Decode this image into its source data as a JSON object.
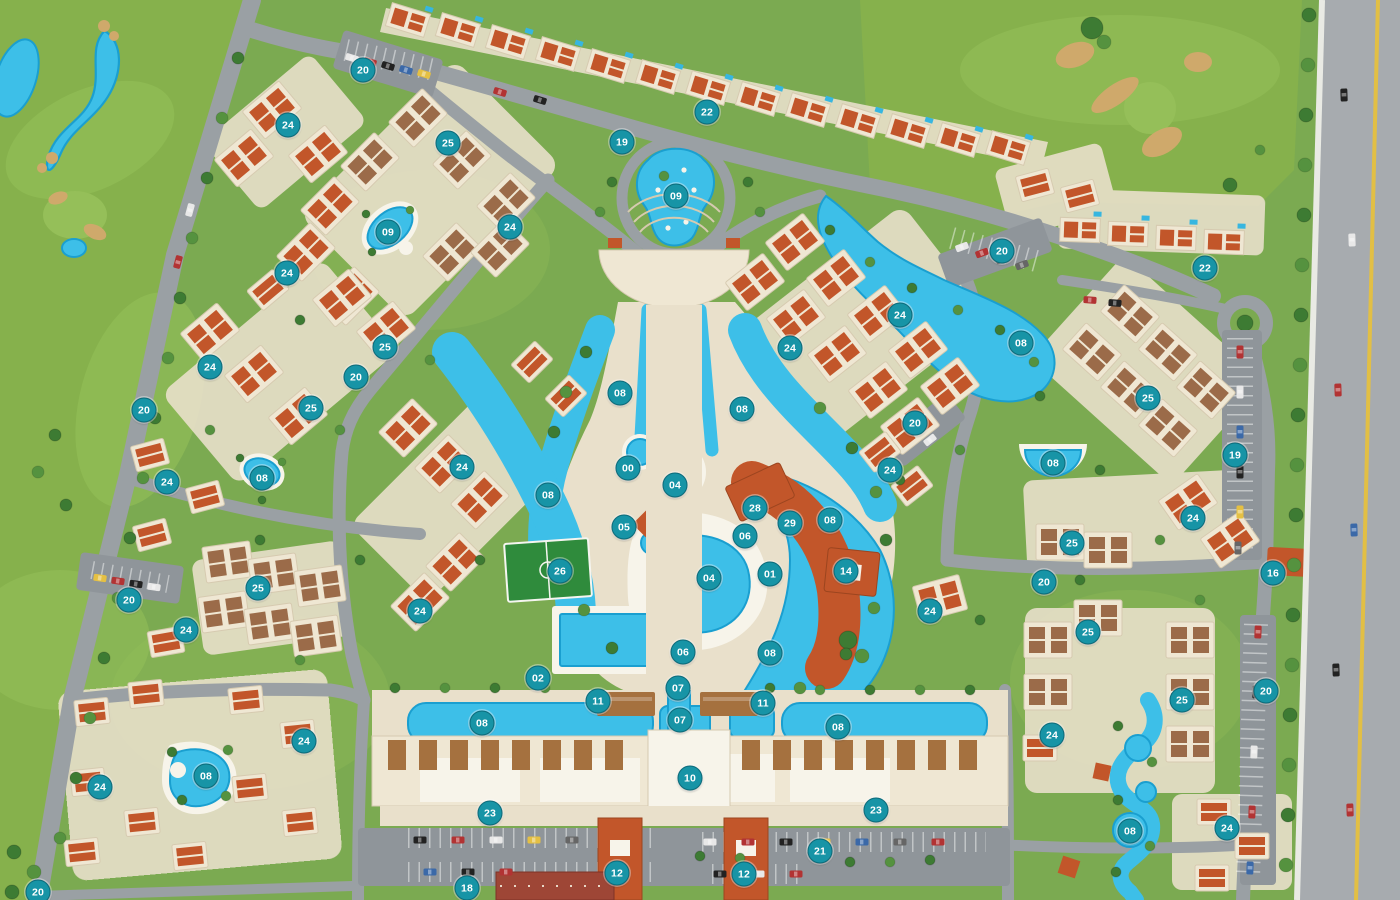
{
  "map": {
    "marker_style": {
      "bg": "#1794a6",
      "border": "#0b6b7a",
      "text": "#ffffff",
      "size": 23
    },
    "palette": {
      "golf": "#86b14c",
      "golfLight": "#95bf59",
      "ground": "#7baa51",
      "treeDark": "#3d7b33",
      "treeMid": "#55923f",
      "road": "#9aa0a4",
      "roadLight": "#a7abaf",
      "curb": "#e9eae4",
      "parking": "#8f959a",
      "cream": "#efe7d3",
      "creamShade": "#d6cab0",
      "deck": "#e9e0cb",
      "white": "#f7f4ea",
      "terracotta": "#c2562a",
      "terracottaDark": "#9c451f",
      "brownRoof": "#9b6b49",
      "pergola": "#a5713f",
      "pool": "#3dbfe8",
      "poolDeep": "#1a9fd0",
      "field": "#2f8b3c",
      "red": "#9e4636",
      "yellowLine": "#e2bf45",
      "sand": "#cfa96b",
      "hedge": "#2f6b2f"
    },
    "markers": [
      {
        "label": "20",
        "x": 363,
        "y": 70
      },
      {
        "label": "22",
        "x": 707,
        "y": 112
      },
      {
        "label": "19",
        "x": 622,
        "y": 142
      },
      {
        "label": "09",
        "x": 676,
        "y": 196
      },
      {
        "label": "24",
        "x": 288,
        "y": 125
      },
      {
        "label": "25",
        "x": 448,
        "y": 143
      },
      {
        "label": "09",
        "x": 388,
        "y": 232
      },
      {
        "label": "24",
        "x": 510,
        "y": 227
      },
      {
        "label": "24",
        "x": 287,
        "y": 273
      },
      {
        "label": "25",
        "x": 385,
        "y": 347
      },
      {
        "label": "20",
        "x": 356,
        "y": 377
      },
      {
        "label": "25",
        "x": 311,
        "y": 408
      },
      {
        "label": "24",
        "x": 210,
        "y": 367
      },
      {
        "label": "20",
        "x": 144,
        "y": 410
      },
      {
        "label": "24",
        "x": 167,
        "y": 482
      },
      {
        "label": "08",
        "x": 262,
        "y": 478
      },
      {
        "label": "25",
        "x": 258,
        "y": 588
      },
      {
        "label": "20",
        "x": 129,
        "y": 600
      },
      {
        "label": "24",
        "x": 186,
        "y": 630
      },
      {
        "label": "24",
        "x": 100,
        "y": 787
      },
      {
        "label": "08",
        "x": 206,
        "y": 776
      },
      {
        "label": "24",
        "x": 304,
        "y": 741
      },
      {
        "label": "20",
        "x": 38,
        "y": 892
      },
      {
        "label": "18",
        "x": 467,
        "y": 888
      },
      {
        "label": "20",
        "x": 1002,
        "y": 251
      },
      {
        "label": "22",
        "x": 1205,
        "y": 268
      },
      {
        "label": "24",
        "x": 900,
        "y": 315
      },
      {
        "label": "24",
        "x": 790,
        "y": 348
      },
      {
        "label": "08",
        "x": 1021,
        "y": 343
      },
      {
        "label": "20",
        "x": 915,
        "y": 423
      },
      {
        "label": "25",
        "x": 1148,
        "y": 398
      },
      {
        "label": "19",
        "x": 1235,
        "y": 455
      },
      {
        "label": "08",
        "x": 1053,
        "y": 463
      },
      {
        "label": "24",
        "x": 1193,
        "y": 518
      },
      {
        "label": "25",
        "x": 1072,
        "y": 543
      },
      {
        "label": "16",
        "x": 1273,
        "y": 573
      },
      {
        "label": "20",
        "x": 1044,
        "y": 582
      },
      {
        "label": "24",
        "x": 890,
        "y": 470
      },
      {
        "label": "24",
        "x": 930,
        "y": 611
      },
      {
        "label": "25",
        "x": 1088,
        "y": 632
      },
      {
        "label": "25",
        "x": 1182,
        "y": 700
      },
      {
        "label": "20",
        "x": 1266,
        "y": 691
      },
      {
        "label": "24",
        "x": 1052,
        "y": 735
      },
      {
        "label": "08",
        "x": 1130,
        "y": 831
      },
      {
        "label": "24",
        "x": 1227,
        "y": 828
      },
      {
        "label": "08",
        "x": 620,
        "y": 393
      },
      {
        "label": "08",
        "x": 742,
        "y": 409
      },
      {
        "label": "08",
        "x": 548,
        "y": 495
      },
      {
        "label": "00",
        "x": 628,
        "y": 468
      },
      {
        "label": "04",
        "x": 675,
        "y": 485
      },
      {
        "label": "05",
        "x": 624,
        "y": 527
      },
      {
        "label": "06",
        "x": 745,
        "y": 536
      },
      {
        "label": "28",
        "x": 755,
        "y": 508
      },
      {
        "label": "29",
        "x": 790,
        "y": 523
      },
      {
        "label": "01",
        "x": 770,
        "y": 574
      },
      {
        "label": "14",
        "x": 846,
        "y": 571
      },
      {
        "label": "08",
        "x": 830,
        "y": 520
      },
      {
        "label": "04",
        "x": 709,
        "y": 578
      },
      {
        "label": "26",
        "x": 560,
        "y": 571
      },
      {
        "label": "08",
        "x": 770,
        "y": 653
      },
      {
        "label": "06",
        "x": 683,
        "y": 652
      },
      {
        "label": "07",
        "x": 678,
        "y": 688
      },
      {
        "label": "07",
        "x": 680,
        "y": 720
      },
      {
        "label": "11",
        "x": 598,
        "y": 701
      },
      {
        "label": "11",
        "x": 763,
        "y": 703
      },
      {
        "label": "08",
        "x": 482,
        "y": 723
      },
      {
        "label": "08",
        "x": 838,
        "y": 727
      },
      {
        "label": "10",
        "x": 690,
        "y": 778
      },
      {
        "label": "23",
        "x": 490,
        "y": 813
      },
      {
        "label": "23",
        "x": 876,
        "y": 810
      },
      {
        "label": "12",
        "x": 617,
        "y": 873
      },
      {
        "label": "12",
        "x": 744,
        "y": 874
      },
      {
        "label": "21",
        "x": 820,
        "y": 851
      },
      {
        "label": "24",
        "x": 462,
        "y": 467
      },
      {
        "label": "24",
        "x": 420,
        "y": 611
      },
      {
        "label": "02",
        "x": 538,
        "y": 678
      }
    ]
  }
}
